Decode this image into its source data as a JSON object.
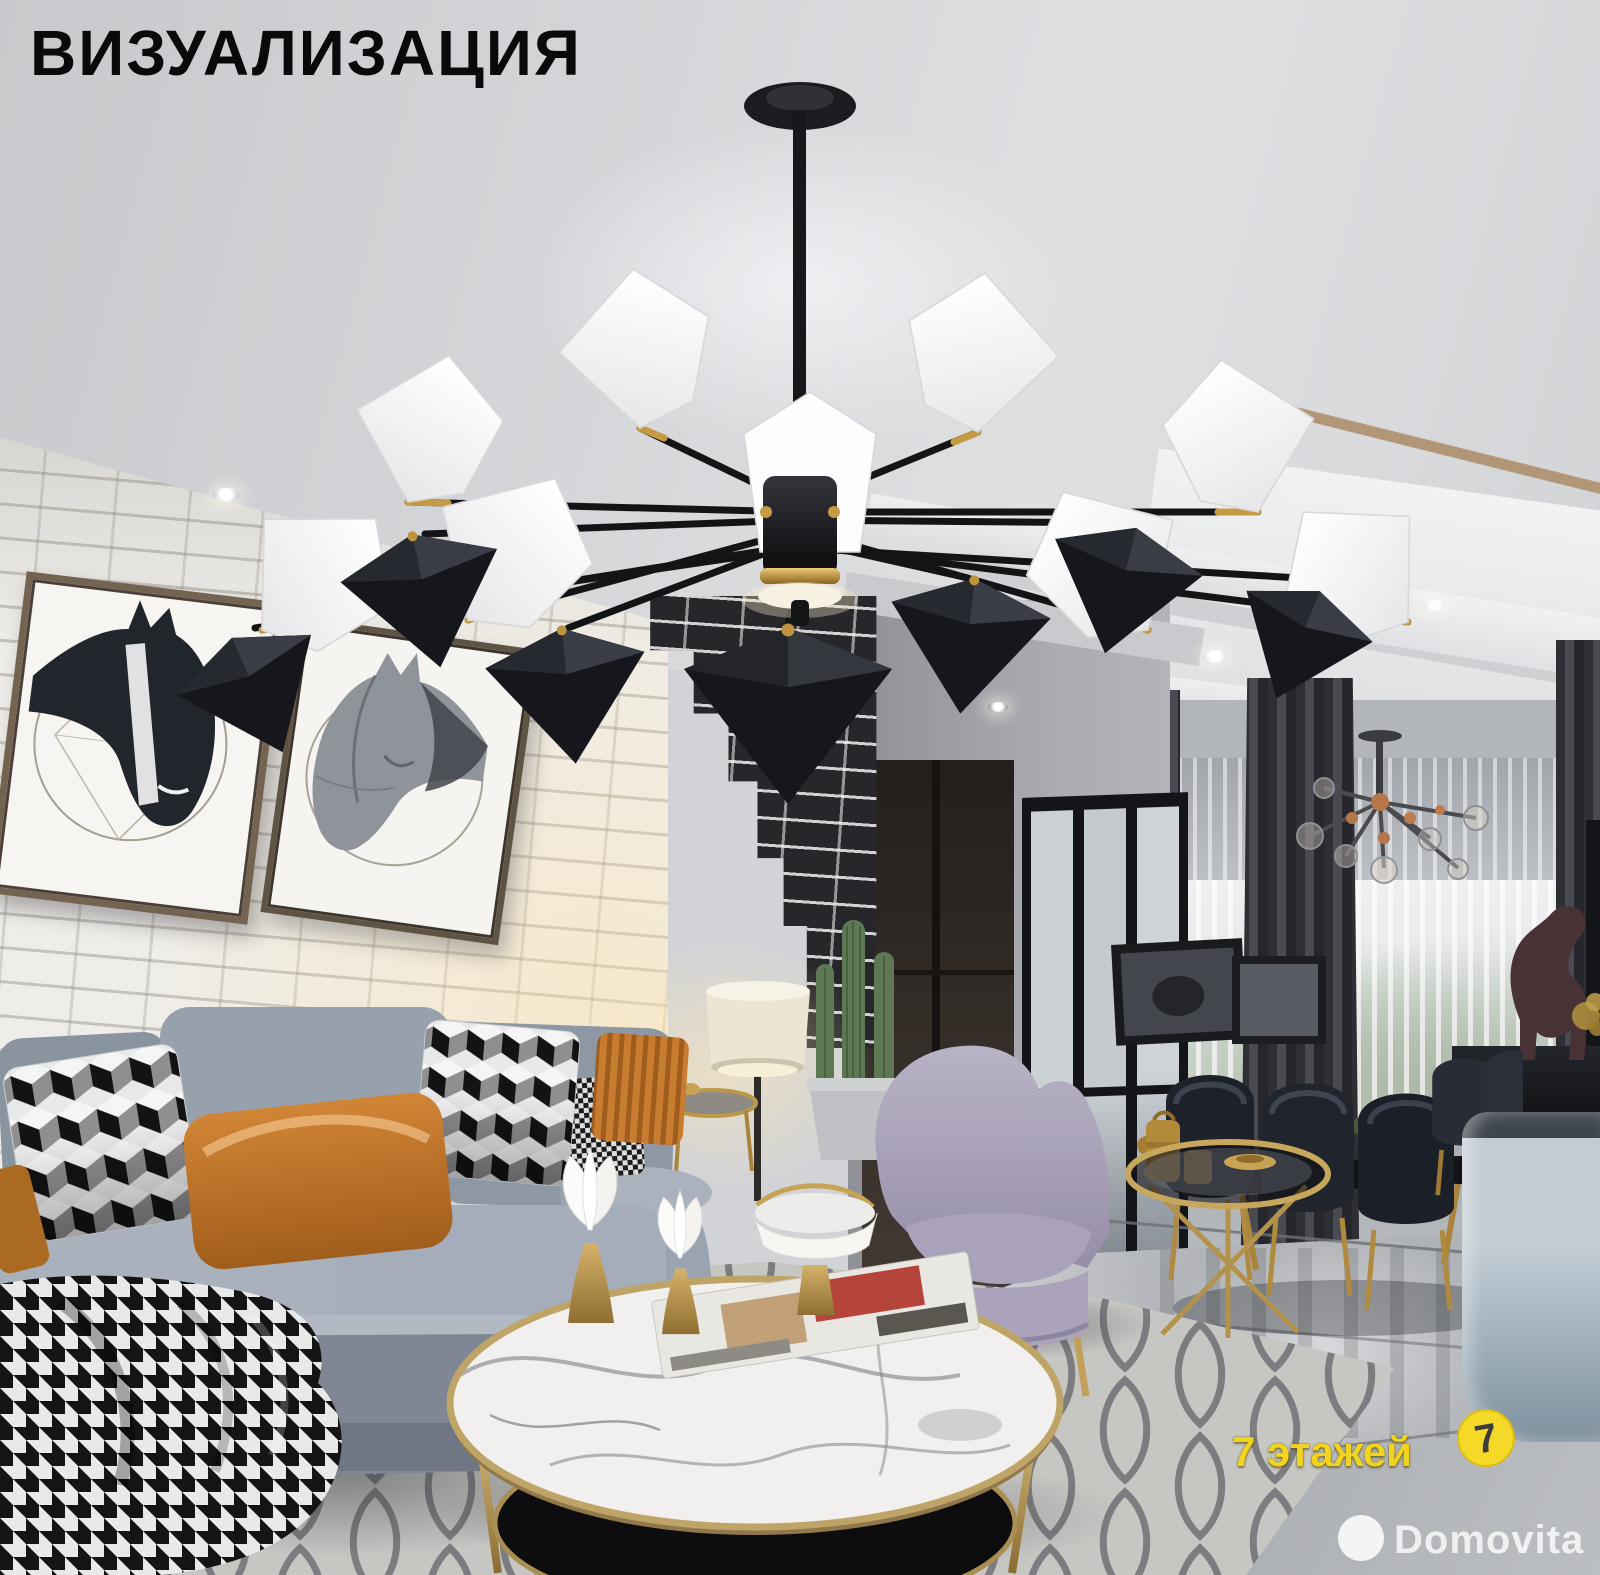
{
  "overlay": {
    "title": "ВИЗУАЛИЗАЦИЯ"
  },
  "watermarks": {
    "floors": {
      "text": "7 этажей",
      "logo_digit": "7",
      "color": "#f2d41f"
    },
    "brand": {
      "text": "Domovita",
      "color": "#ffffff"
    }
  },
  "palette": {
    "ceiling": "#d4d5d8",
    "white_brick": "#efede9",
    "black_brick": "#26262b",
    "wood_trim": "#b29678",
    "sofa_gray": "#98a1ae",
    "pillow_orange": "#c07a2e",
    "armchair_lavender": "#b3abc4",
    "gold_accent": "#c2a05a",
    "marble_table": "#f1f0ee",
    "rug_gray": "#c8c8c6",
    "dark_curtain": "#3a3b41",
    "floor_marble": "#b9bcc0",
    "chandelier_black": "#1a1b1f",
    "watermark_yellow": "#f2d41f"
  }
}
